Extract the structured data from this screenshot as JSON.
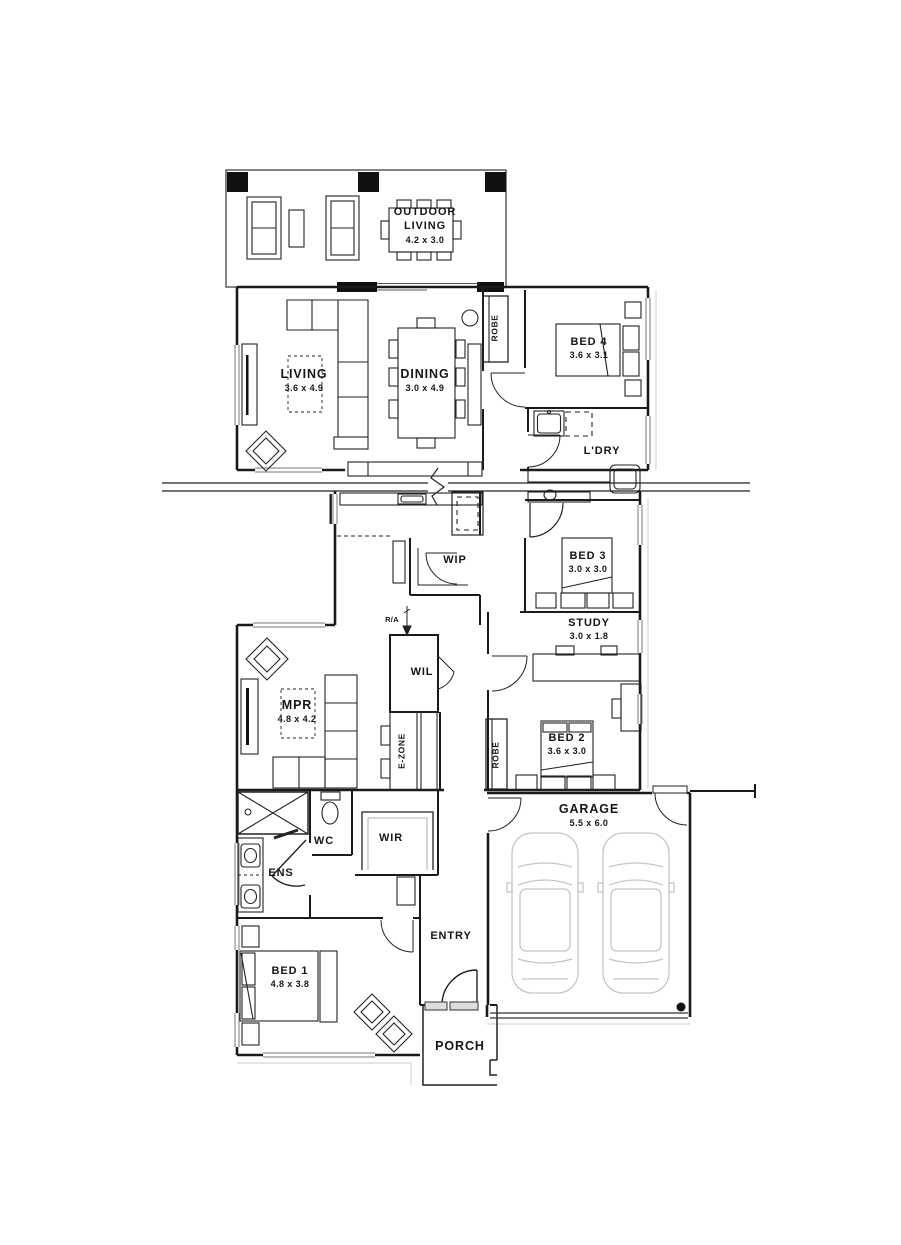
{
  "rooms": {
    "outdoor_living": {
      "name": "OUTDOOR LIVING",
      "dims": "4.2 x 3.0"
    },
    "living": {
      "name": "LIVING",
      "dims": "3.6 x 4.9"
    },
    "dining": {
      "name": "DINING",
      "dims": "3.0 x 4.9"
    },
    "bed4": {
      "name": "BED 4",
      "dims": "3.6 x 3.1"
    },
    "ldry": {
      "name": "L'DRY"
    },
    "robe_hall": {
      "name": "ROBE"
    },
    "wip": {
      "name": "WIP"
    },
    "bed3": {
      "name": "BED 3",
      "dims": "3.0 x 3.0"
    },
    "study": {
      "name": "STUDY",
      "dims": "3.0 x 1.8"
    },
    "mpr": {
      "name": "MPR",
      "dims": "4.8 x 4.2"
    },
    "wil": {
      "name": "WIL"
    },
    "ezone": {
      "name": "E-ZONE"
    },
    "robe_bed2": {
      "name": "ROBE"
    },
    "bed2": {
      "name": "BED 2",
      "dims": "3.6 x 3.0"
    },
    "garage": {
      "name": "GARAGE",
      "dims": "5.5 x 6.0"
    },
    "ens": {
      "name": "ENS"
    },
    "wc": {
      "name": "WC"
    },
    "wir": {
      "name": "WIR"
    },
    "entry": {
      "name": "ENTRY"
    },
    "bed1": {
      "name": "BED 1",
      "dims": "4.8 x 3.8"
    },
    "porch": {
      "name": "PORCH"
    }
  },
  "annotations": {
    "return_air": "R/A"
  },
  "colors": {
    "line": "#1a1a1a",
    "light_line": "#c5c5c5",
    "background": "#ffffff"
  }
}
